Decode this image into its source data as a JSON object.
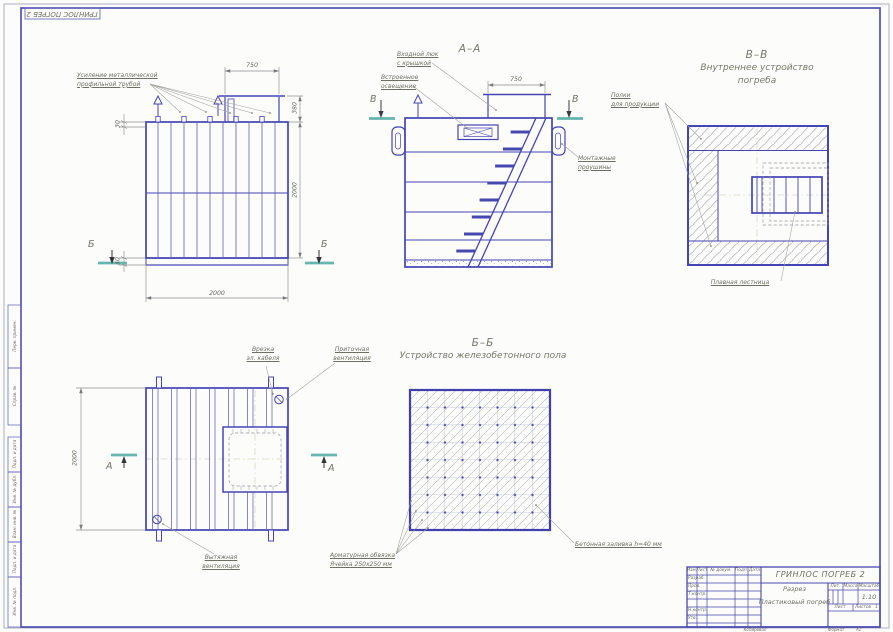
{
  "sheet": {
    "corner_stamp": "ГРИНЛОС ПОГРЕБ 2",
    "copied": "Копировал",
    "format_label": "Формат",
    "format_value": "А1",
    "margin_stamps": [
      "Перв. примен.",
      "Справ. №",
      "Подп. и дата",
      "Инв. № дубл.",
      "Взам. инв. №",
      "Подп. и дата",
      "Инв. № подл."
    ]
  },
  "views": {
    "front": {
      "label_reinforcement": "Усиление металлической\nпрофильной трубой",
      "dim_750": "750",
      "dim_380": "380",
      "dim_2000_right": "2000",
      "dim_30": "30",
      "dim_40": "40",
      "dim_2000_bottom": "2000",
      "section_letter": "Б"
    },
    "section_aa": {
      "title": "А–А",
      "label_hatch": "Входной люк\nс крышкой",
      "label_light": "Встроенное\nосвещение",
      "label_lugs": "Монтажные\nпроушины",
      "dim_750": "750",
      "section_letter": "В"
    },
    "section_vv": {
      "title": "В–В",
      "subtitle": "Внутреннее устройство погреба",
      "label_shelves": "Полки\nдля продукции",
      "label_ladder": "Плавная лестница"
    },
    "plan": {
      "label_cable": "Врезка\nэл. кабеля",
      "label_supply": "Приточная\nвентиляция",
      "label_exhaust": "Вытяжная\nвентиляция",
      "dim_2000": "2000",
      "section_letter": "А"
    },
    "section_bb": {
      "title": "Б–Б",
      "subtitle": "Устройство железобетонного пола",
      "label_rebar": "Арматурная обвязка\nЯчейка 250х250 мм",
      "label_concrete": "Бетонная заливка h=40 мм"
    }
  },
  "title_block": {
    "doc_title": "ГРИНЛОС ПОГРЕБ 2",
    "type_name": "Разрез",
    "object_name": "Пластиковый погреб",
    "header_cols": [
      "Изм.",
      "Лист",
      "№ докум.",
      "Подп.",
      "Дата"
    ],
    "sign_rows": [
      "Разраб.",
      "Пров.",
      "Т.контр.",
      "Н.контр.",
      "Утв."
    ],
    "lit_label": "Лит.",
    "mass_label": "Масса",
    "scale_label": "Масштаб",
    "scale_value": "1:10",
    "sheet_label": "Лист",
    "sheets_label": "Листов",
    "sheets_value": "1"
  },
  "colors": {
    "line_blue": "#4444b4",
    "teal": "#66b5ae",
    "text": "#6e6e64"
  }
}
